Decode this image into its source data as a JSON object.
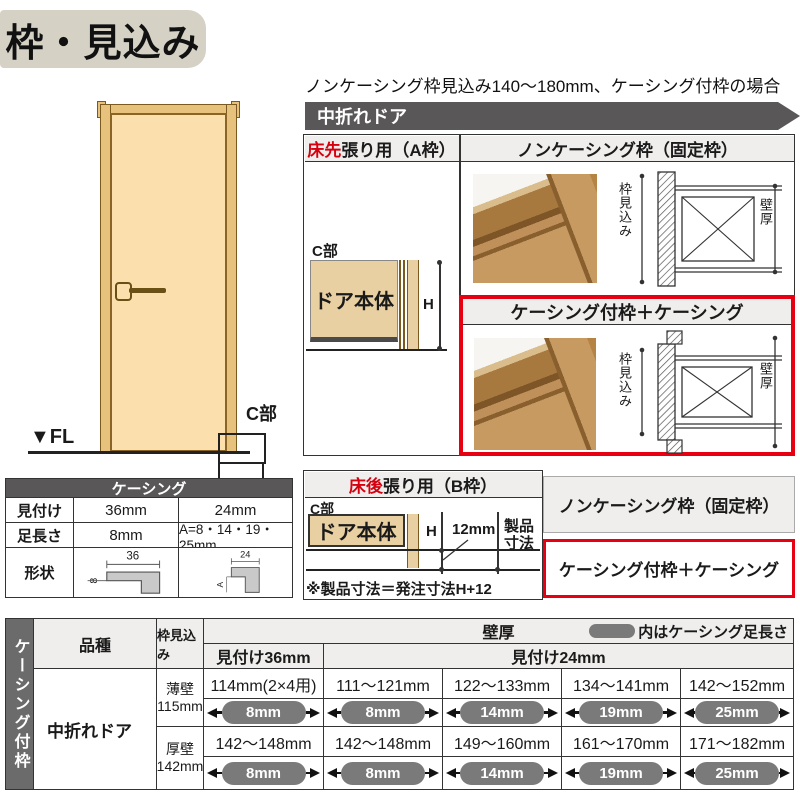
{
  "title": "枠・見込み",
  "top_note": "ノンケーシング枠見込み140～180mm、ケーシング付枠の場合",
  "banner": "中折れドア",
  "labels": {
    "c": "C部",
    "fl": "▼FL",
    "door_body": "ドア本体",
    "h": "H",
    "depth": "枠見込み",
    "wall": "壁厚"
  },
  "section_a": {
    "header_left_em": "床先",
    "header_left": "張り用（A枠）",
    "noncasing_header": "ノンケーシング枠（固定枠）",
    "casing_header": "ケーシング付枠＋ケーシング"
  },
  "casing_table": {
    "title": "ケーシング",
    "row_mitsuke": {
      "label": "見付け",
      "v36": "36mm",
      "v24": "24mm"
    },
    "row_ashinaga": {
      "label": "足長さ",
      "v36": "8mm",
      "v24": "A=8・14・19・25mm"
    },
    "row_shape": {
      "label": "形状",
      "w36": "36",
      "t36": "8",
      "w24": "24",
      "t24": "A"
    }
  },
  "section_b": {
    "header_em": "床後",
    "header": "張り用（B枠）",
    "gap": "12mm",
    "product_line1": "製品",
    "product_line2": "寸法",
    "note": "※製品寸法＝発注寸法H+12",
    "right_top": "ノンケーシング枠（固定枠）",
    "right_bottom": "ケーシング付枠＋ケーシング"
  },
  "bottom_table": {
    "side_label": "ケーシング付枠",
    "col_kind": "品種",
    "col_depth": "枠見込み",
    "wall_header": "壁厚",
    "legend": "内はケーシング足長さ",
    "sub_36": "見付け36mm",
    "sub_24": "見付け24mm",
    "kind": "中折れドア",
    "rows": [
      {
        "wall_type": "薄壁",
        "wall_size": "115mm",
        "values": [
          "114mm(2×4用)",
          "111～121mm",
          "122～133mm",
          "134～141mm",
          "142～152mm"
        ],
        "pills": [
          "8mm",
          "8mm",
          "14mm",
          "19mm",
          "25mm"
        ]
      },
      {
        "wall_type": "厚壁",
        "wall_size": "142mm",
        "values": [
          "142～148mm",
          "142～148mm",
          "149～160mm",
          "161～170mm",
          "171～182mm"
        ],
        "pills": [
          "8mm",
          "8mm",
          "14mm",
          "19mm",
          "25mm"
        ]
      }
    ]
  },
  "colors": {
    "accent_red": "#e60012",
    "dark_bar": "#595757",
    "pill_gray": "#7a7a7a",
    "wood_tan": "#e9d0a2"
  }
}
